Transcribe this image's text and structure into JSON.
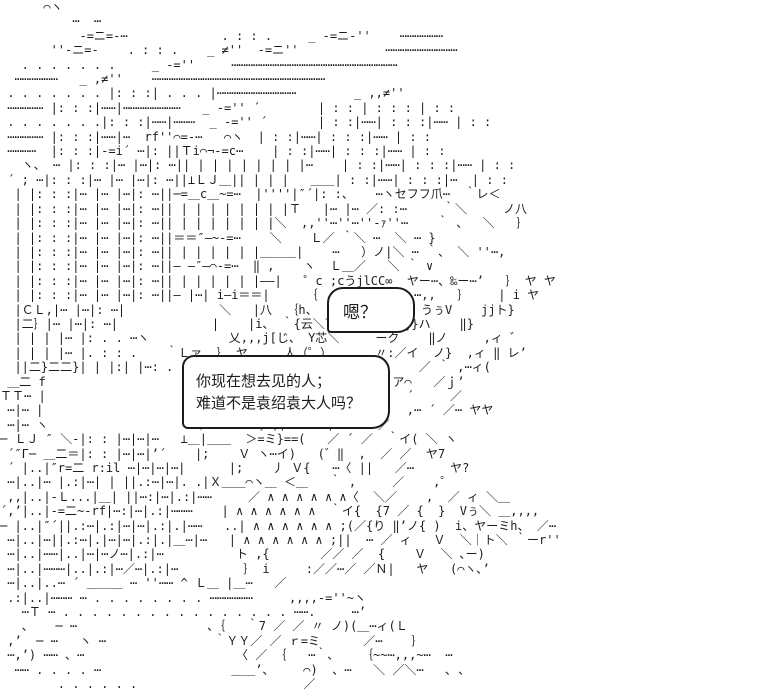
{
  "scene": {
    "background_color": "#ffffff",
    "ink_color": "#1c1c1c",
    "description": "ascii-art-scene-building-and-character"
  },
  "dialogue": {
    "bubble_small": {
      "text": "嗯？"
    },
    "bubble_main": {
      "line1": "你现在想去见的人；",
      "line2": "难道不是袁绍袁大人吗？"
    }
  },
  "ascii_art": {
    "lines": [
      "      ⌒ヽ",
      "          ⋯  ⋯",
      "           ‐=ニ=‐⋯             . : : .     _ ‐=ニ‐''    ⋯⋯⋯⋯⋯⋯",
      "       ''‐ニ=‐    . : : .    _ ≠''  ‐=ニ''            ⋯⋯⋯⋯⋯⋯⋯⋯⋯⋯",
      "   . . . . . . .     _ ‐=''     ⋯⋯⋯⋯⋯⋯⋯⋯⋯⋯⋯⋯⋯⋯⋯⋯⋯⋯⋯⋯⋯⋯⋯",
      "  ⋯⋯⋯⋯⋯⋯   _ ,≠''    ⋯⋯⋯⋯⋯⋯⋯⋯⋯⋯⋯⋯⋯⋯⋯⋯⋯⋯⋯⋯⋯⋯⋯⋯",
      " . . . . . . . |: : :| . . . |⋯⋯⋯⋯⋯⋯⋯⋯⋯⋯⋯        _ ,,≠''",
      " ⋯⋯⋯⋯⋯ |: : :|⋯⋯|⋯⋯⋯⋯⋯⋯⋯⋯   _ ‐='' ´        | : : | : : : | : :",
      " . . . . . . .|: : :|⋯⋯|⋯⋯⋯  _ ‐='' ´       | : :|⋯⋯| : : :|⋯⋯ | : :",
      " ⋯⋯⋯⋯⋯ |: : :|⋯⋯|⋯  rf''⌒=‐⋯   ⌒ヽ  | : :|⋯⋯| : : :|⋯⋯ | : :",
      " ⋯⋯⋯⋯  |: : :|‐=i´ ⋯|: ||Ｔi⌒¬‐=c⋯    | : :|⋯⋯| : : :|⋯⋯ | : :",
      "   ヽ、 ⋯ |: : :|⋯ |⋯|: ⋯|| | | | | | | | |⋯    | : :|⋯⋯| : : :|⋯⋯ | : :",
      " ´ ; ⋯|: : :|⋯ |⋯ |⋯|: ⋯||⊥ＬＪ＿|| | | |   ＿＿| : :|⋯⋯| : : :|⋯  | : :",
      "  | |: : :|⋯ |⋯ |⋯|: ⋯||─=＿c＿~=⋯  |''''|″´|: :、   ⋯ヽセフフ爪⋯  ｀レ＜",
      "  | |: : :|⋯ |⋯ |⋯|: ⋯|| | | | | | | | |Ｔ   |⋯ |⋯ ／: :⋯     ｀＼     ノ八",
      "  | |: : :|⋯ |⋯ |⋯|: ⋯|| | | | | | | |＼  ,,''⋯''⋯''‐ｧ''⋯    ｀ 、  ＼   ｝",
      "  | |: : :|⋯ |⋯ |⋯|: ⋯||＝＝″—~‐=⋯    ＼    Ｌ／ ｀＼ ⋯  ＼ ⋯ }",
      "  | |: : :|⋯ |⋯ |⋯|: ⋯|| | | | | | |＿＿＿|    ⋯   ）ノ|＼ ⋯ ｀、 ＼ ''⋯,",
      "  | |: : :|⋯ |⋯ |⋯|: ⋯||— —″—⌒‐=⋯  ‖ ,    ヽ  Ｌ＿／   ＼ ｀ ∨",
      "  | |: : :|⋯ |⋯ |⋯|: ⋯|| | | | | | |——|   ゜c ;cうjlCC∞  ヤー⋯、‰ー⋯’   ｝ ヤ ヤ",
      "  | |: : :|⋯ |⋯ |⋯|: ⋯||— |⋯| i—i＝＝|     ｛    jl ＼ ／,,⋯,,   ｝    | i ヤ",
      "  |ＣＬ,|⋯ |⋯|: ⋯|             ＼   |八  ｛h、   |リ姷芋ミ刈  うぅV    jjト}",
      "  |二｝|⋯ |⋯|: ⋯|             |    |i、 ｀{云＼＼  〈じ}‖  j}ハ    ‖}",
      "  | | | |⋯ |: . . ⋯ヽ           乂,,,j[じ、 Y芯＼     ーク    ‖ノ     ,ィ ゛",
      "  | | | |⋯ |. : : .    ｀Ｌァ  ｝ ヤ     人（゜）      〃:／イ  ノ}  ,ィ ‖ レ’",
      "  ||二}二二}| | |:| |⋯: . .         ヽ{’,゜⋯,,,,＼∵         ／ ｀ ,⋯ィ(",
      " ＿二 f                        |ヤト‰   ─下..,          ア⌒   ／ｊ’",
      "ＴＴ⋯ |                        | }iノ ｝   人{´ヽヽァ⌒     ´     ／",
      " ⋯|⋯ |                        乂 {    ノ  ／  ヽ }〈      ,⋯ ´ ／⋯ ヤヤ",
      " ⋯|⋯ ヽ                    ’／⌒ヽ    ｝,,   ｀ ,      ／",
      "─ ＬＪ ″ ＼‐|: : |⋯|⋯|⋯   ⊥＿|＿＿  ＞=ミ}==(   ／ ´ ／  ｀イ( ＼ ヽ",
      " ´″Γ─ ＿二＝|: : |⋯|⋯|’´    |;    Ｖ ヽ⋯イ)   (゛‖  ,  ／ ／  ヤ7",
      " ´ |..|″r=二 r:il ⋯|⋯|⋯|⋯|      |;    丿 Ｖ{   ⋯〈 ||   ／⋯     ヤ?",
      " ⋯|..|⋯ |.:|⋯| | ||.:⋯|⋯|. .|Ｘ＿＿⌒ヽ＿ ＜＿   ｀ ,     ／    ,゜",
      " ,,|..|‐Ｌ...|＿| ||⋯:|⋯|.:|⋯⋯     ／ ∧ ∧ ∧ ∧ ∧ ∧〈  ＼／    ,  ／ ィ ＼＿",
      "´,’|..|‐=二~‐rf|⋯:|⋯|.:|⋯⋯⋯    | ∧ ∧ ∧ ∧ ∧ ∧  ｀イ{  {7 ／ {  }  Vぅ＼ ＿,,,,",
      "─ |..|″´||.:⋯|.:|⋯|⋯|.:|.|⋯⋯   ..| ∧ ∧ ∧ ∧ ∧ ∧ ;(／{り ‖’ノ{ )  i、ヤーミh、 ／⋯",
      " ⋯|..|⋯||.:⋯|.|⋯|⋯|.:|.|＿⋯|⋯   | ∧ ∧ ∧ ∧ ∧ ∧ ;||  ⋯ ／ ィ   Ｖ  ＼｜ト＼ ｀ーr''",
      " ⋯|..|⋯⋯|..|⋯|⋯ノ⋯|.:|⋯          ト ,{       ／／ ／  {    Ｖ  ＼ ､ー)",
      " ⋯|..|⋯⋯⋯|..|.:|⋯／⋯|.:|⋯         ｝ i     :／／⋯／ ／Ｎ|   ヤ   (⌒ヽ､’",
      " ⋯|..|..⋯ ´ ＿＿＿ ⋯ ''⋯⋯ ^ Ｌ＿ |＿⋯   ／",
      " .:|..|⋯⋯⋯ ⋯ . . . . . . . . ⋯⋯⋯⋯⋯⋯     ,,,,‐=''~ヽ",
      "   ⋯Ｔ ⋯ . . . . . . . . . . . . . . . . ⋯⋯.     ⋯’",
      "   、   ─ ⋯                  、｛   ｀7 ／ ／ 〃 ノ)(＿⋯ィ(Ｌ",
      " ,’  ─ ⋯   ヽ ⋯               ｀ＹＹ／ ／ ｒ=ミ      ／⋯    ｝",
      " ⋯,’) ⋯⋯ 、⋯                     〈 ／ ｛   ⋯｀、   ｛~~⋯,,,~⋯  ⋯",
      "  ⋯⋯ . . . . ⋯                  ＿＿’、    ⌒)  、⋯   ＼ ／＼⋯   ､ ､",
      "        . . . . . .                       ／"
    ]
  }
}
